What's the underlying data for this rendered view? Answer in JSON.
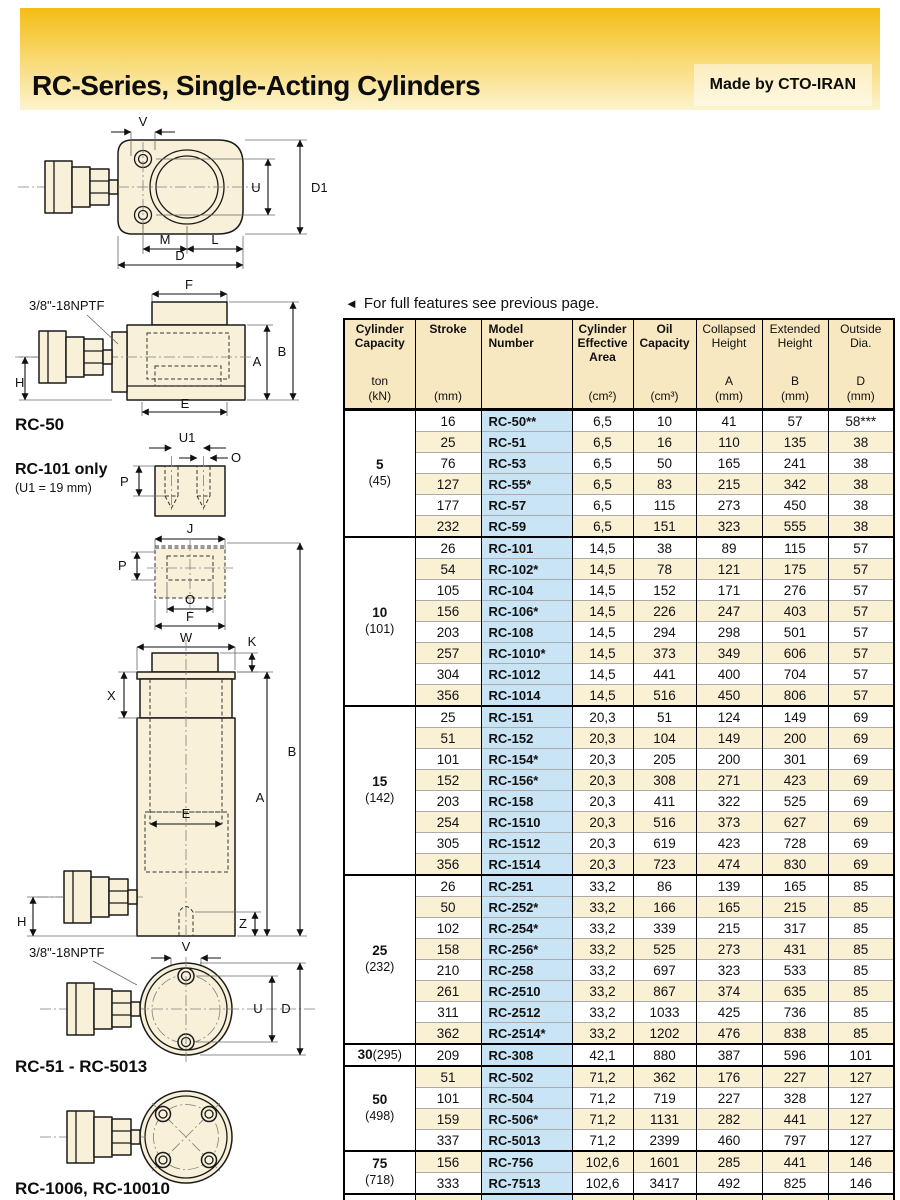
{
  "page": {
    "title": "RC-Series, Single-Acting Cylinders",
    "made_by": "Made by CTO-IRAN",
    "note_arrow": "◄",
    "note_text": "For full features see previous page."
  },
  "colors": {
    "banner_top": "#f4bd14",
    "banner_bottom": "#fdf3cf",
    "table_header_bg": "#f8e8c2",
    "model_column_bg": "#c9e4f4",
    "row_stripe_bg": "#faf0d4"
  },
  "diagrams": {
    "top_view": {
      "labels": {
        "v": "V",
        "u": "U",
        "d1": "D1",
        "m": "M",
        "l": "L",
        "d": "D"
      }
    },
    "side_view": {
      "port": "3/8\"-18NPTF",
      "caption": "RC-50",
      "labels": {
        "f": "F",
        "b": "B",
        "a": "A",
        "h": "H",
        "e": "E"
      }
    },
    "rc101_saddle": {
      "caption": "RC-101 only",
      "note": "(U1 = 19 mm)",
      "labels": {
        "u1": "U1",
        "o": "O",
        "p": "P"
      }
    },
    "saddle_detail": {
      "labels": {
        "j": "J",
        "p": "P",
        "o": "O",
        "f": "F"
      }
    },
    "cylinder_view": {
      "labels": {
        "w": "W",
        "k": "K",
        "x": "X",
        "b": "B",
        "a": "A",
        "e": "E",
        "h": "H",
        "z": "Z"
      }
    },
    "base_view": {
      "port": "3/8\"-18NPTF",
      "caption": "RC-51 - RC-5013",
      "labels": {
        "v": "V",
        "u": "U",
        "d": "D"
      }
    },
    "four_bolt_view": {
      "caption": "RC-1006, RC-10010"
    }
  },
  "table": {
    "columns": [
      {
        "title": "Cylinder Capacity",
        "sub1": "ton",
        "sub2": "(kN)",
        "bold": true
      },
      {
        "title": "Stroke",
        "sub1": "",
        "sub2": "(mm)",
        "bold": true
      },
      {
        "title": "Model Number",
        "sub1": "",
        "sub2": "",
        "bold": true
      },
      {
        "title": "Cylinder Effective Area",
        "sub1": "",
        "sub2": "(cm²)",
        "bold": true
      },
      {
        "title": "Oil Capacity",
        "sub1": "",
        "sub2": "(cm³)",
        "bold": true
      },
      {
        "title": "Collapsed Height",
        "sub1": "A",
        "sub2": "(mm)",
        "bold": false
      },
      {
        "title": "Extended Height",
        "sub1": "B",
        "sub2": "(mm)",
        "bold": false
      },
      {
        "title": "Outside Dia.",
        "sub1": "D",
        "sub2": "(mm)",
        "bold": false
      }
    ],
    "groups": [
      {
        "capacity": "5",
        "kn": "(45)",
        "inline": false,
        "rows": [
          [
            "16",
            "RC-50**",
            "6,5",
            "10",
            "41",
            "57",
            "58***"
          ],
          [
            "25",
            "RC-51",
            "6,5",
            "16",
            "110",
            "135",
            "38"
          ],
          [
            "76",
            "RC-53",
            "6,5",
            "50",
            "165",
            "241",
            "38"
          ],
          [
            "127",
            "RC-55*",
            "6,5",
            "83",
            "215",
            "342",
            "38"
          ],
          [
            "177",
            "RC-57",
            "6,5",
            "115",
            "273",
            "450",
            "38"
          ],
          [
            "232",
            "RC-59",
            "6,5",
            "151",
            "323",
            "555",
            "38"
          ]
        ]
      },
      {
        "capacity": "10",
        "kn": "(101)",
        "inline": false,
        "rows": [
          [
            "26",
            "RC-101",
            "14,5",
            "38",
            "89",
            "115",
            "57"
          ],
          [
            "54",
            "RC-102*",
            "14,5",
            "78",
            "121",
            "175",
            "57"
          ],
          [
            "105",
            "RC-104",
            "14,5",
            "152",
            "171",
            "276",
            "57"
          ],
          [
            "156",
            "RC-106*",
            "14,5",
            "226",
            "247",
            "403",
            "57"
          ],
          [
            "203",
            "RC-108",
            "14,5",
            "294",
            "298",
            "501",
            "57"
          ],
          [
            "257",
            "RC-1010*",
            "14,5",
            "373",
            "349",
            "606",
            "57"
          ],
          [
            "304",
            "RC-1012",
            "14,5",
            "441",
            "400",
            "704",
            "57"
          ],
          [
            "356",
            "RC-1014",
            "14,5",
            "516",
            "450",
            "806",
            "57"
          ]
        ]
      },
      {
        "capacity": "15",
        "kn": "(142)",
        "inline": false,
        "rows": [
          [
            "25",
            "RC-151",
            "20,3",
            "51",
            "124",
            "149",
            "69"
          ],
          [
            "51",
            "RC-152",
            "20,3",
            "104",
            "149",
            "200",
            "69"
          ],
          [
            "101",
            "RC-154*",
            "20,3",
            "205",
            "200",
            "301",
            "69"
          ],
          [
            "152",
            "RC-156*",
            "20,3",
            "308",
            "271",
            "423",
            "69"
          ],
          [
            "203",
            "RC-158",
            "20,3",
            "411",
            "322",
            "525",
            "69"
          ],
          [
            "254",
            "RC-1510",
            "20,3",
            "516",
            "373",
            "627",
            "69"
          ],
          [
            "305",
            "RC-1512",
            "20,3",
            "619",
            "423",
            "728",
            "69"
          ],
          [
            "356",
            "RC-1514",
            "20,3",
            "723",
            "474",
            "830",
            "69"
          ]
        ]
      },
      {
        "capacity": "25",
        "kn": "(232)",
        "inline": false,
        "rows": [
          [
            "26",
            "RC-251",
            "33,2",
            "86",
            "139",
            "165",
            "85"
          ],
          [
            "50",
            "RC-252*",
            "33,2",
            "166",
            "165",
            "215",
            "85"
          ],
          [
            "102",
            "RC-254*",
            "33,2",
            "339",
            "215",
            "317",
            "85"
          ],
          [
            "158",
            "RC-256*",
            "33,2",
            "525",
            "273",
            "431",
            "85"
          ],
          [
            "210",
            "RC-258",
            "33,2",
            "697",
            "323",
            "533",
            "85"
          ],
          [
            "261",
            "RC-2510",
            "33,2",
            "867",
            "374",
            "635",
            "85"
          ],
          [
            "311",
            "RC-2512",
            "33,2",
            "1033",
            "425",
            "736",
            "85"
          ],
          [
            "362",
            "RC-2514*",
            "33,2",
            "1202",
            "476",
            "838",
            "85"
          ]
        ]
      },
      {
        "capacity": "30",
        "kn": "(295)",
        "inline": true,
        "rows": [
          [
            "209",
            "RC-308",
            "42,1",
            "880",
            "387",
            "596",
            "101"
          ]
        ]
      },
      {
        "capacity": "50",
        "kn": "(498)",
        "inline": false,
        "rows": [
          [
            "51",
            "RC-502",
            "71,2",
            "362",
            "176",
            "227",
            "127"
          ],
          [
            "101",
            "RC-504",
            "71,2",
            "719",
            "227",
            "328",
            "127"
          ],
          [
            "159",
            "RC-506*",
            "71,2",
            "1131",
            "282",
            "441",
            "127"
          ],
          [
            "337",
            "RC-5013",
            "71,2",
            "2399",
            "460",
            "797",
            "127"
          ]
        ]
      },
      {
        "capacity": "75",
        "kn": "(718)",
        "inline": false,
        "rows": [
          [
            "156",
            "RC-756",
            "102,6",
            "1601",
            "285",
            "441",
            "146"
          ],
          [
            "333",
            "RC-7513",
            "102,6",
            "3417",
            "492",
            "825",
            "146"
          ]
        ]
      },
      {
        "capacity": "95",
        "kn": "(933)",
        "inline": false,
        "rows": [
          [
            "168",
            "RC-1006",
            "133,3",
            "2239",
            "357",
            "525",
            "177"
          ],
          [
            "260",
            "RC-10010",
            "133,3",
            "3466",
            "449",
            "709",
            "177"
          ]
        ]
      }
    ]
  }
}
